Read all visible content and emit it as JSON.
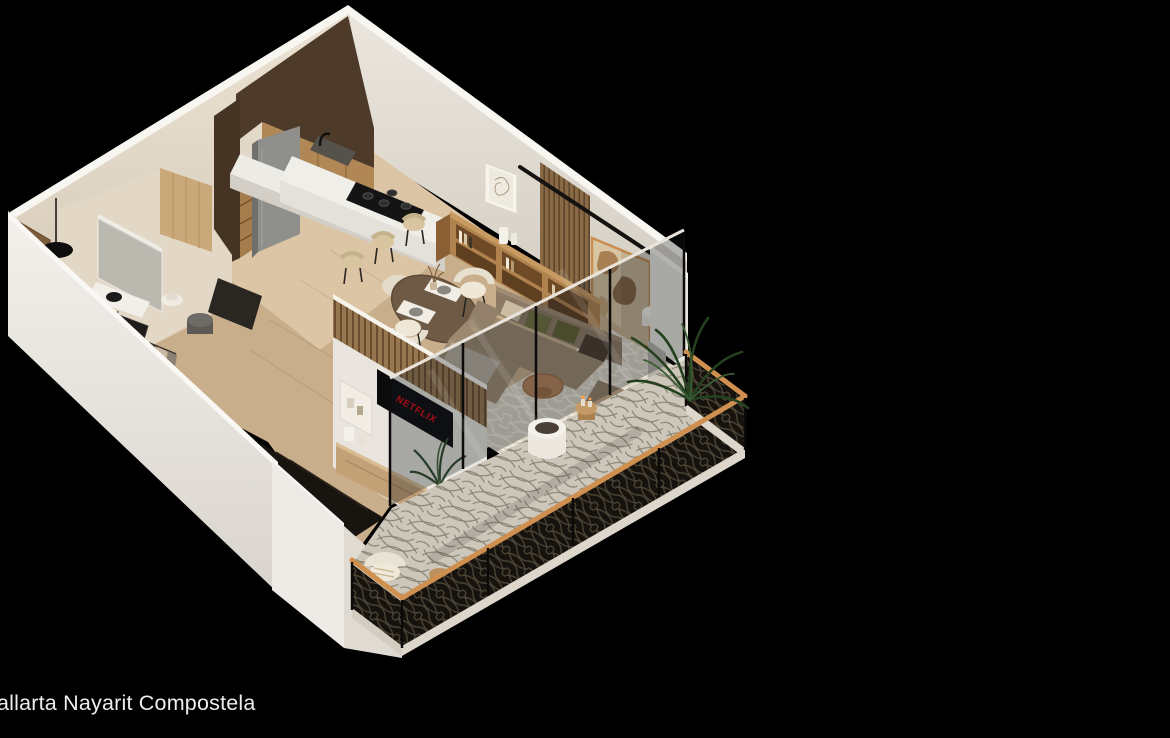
{
  "scene": {
    "caption": "allarta Nayarit Compostela",
    "tv_brand_label": "NETFLIX",
    "description": "Isometric 3D cutaway render of a one-bedroom apartment with kitchen, dining, living room, bathroom, closet, stairs and wrap balcony on a black background"
  },
  "colors": {
    "background": "#000000",
    "caption_text": "#ededed",
    "netflix_red": "#e50914",
    "wall_white": "#f0ede8",
    "wall_inner_beige": "#e6ddd0",
    "floor_wood": "#c9ae8b",
    "cabinet_dark_walnut": "#4e3a29",
    "cabinet_oak": "#b18756",
    "counter_marble": "#edebe5",
    "sofa_taupe": "#9c8970",
    "pillow_olive": "#72703c",
    "art_frame_tan": "#c98d4f",
    "railing_black": "#16120d",
    "handrail_wood": "#cf8f4e",
    "plant_green": "#2e4a2c",
    "glass_tint": "#141a20"
  }
}
